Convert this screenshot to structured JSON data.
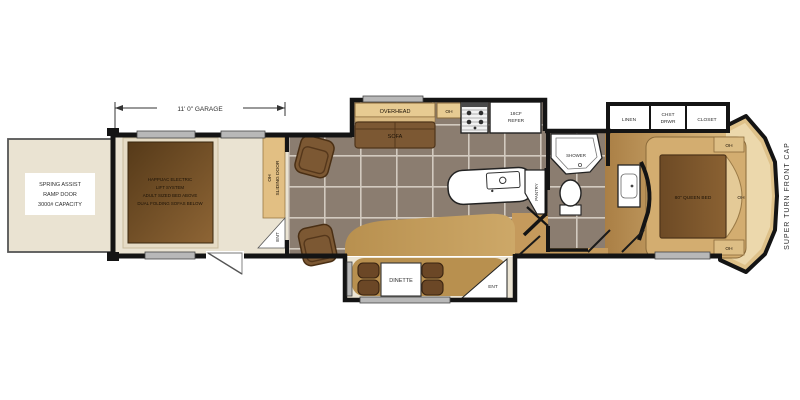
{
  "plan": {
    "dimension_label": "11' 0\" GARAGE",
    "ramp_door": [
      "SPRING ASSIST",
      "RAMP DOOR",
      "3000# CAPACITY"
    ],
    "garage_bed": [
      "HAPPIJAC ELECTRIC",
      "LIFT SYSTEM",
      "ADULT SIZED BED ABOVE",
      "DUAL FOLDING SOFAS BELOW"
    ],
    "garage_wall": {
      "oh": "OH",
      "sliding_door": "SLIDING DOOR",
      "ent": "ENT"
    },
    "living": {
      "overhead": "OVERHEAD",
      "sofa": "SOFA",
      "oh_cabinet": "OH",
      "refer_line1": "18CF",
      "refer_line2": "REFER",
      "pantry": "PANTRY",
      "dinette": "DINETTE",
      "entry": "ENT"
    },
    "bathroom": {
      "shower": "SHOWER"
    },
    "bedroom": {
      "linen": "LINEN",
      "chest_line1": "CHST",
      "chest_line2": "DRWR",
      "closet": "CLOSET",
      "bed": "80\" QUEEN BED",
      "oh_top": "OH",
      "oh_right": "OH",
      "oh_bottom": "OH"
    },
    "front_cap_label": "SUPER TURN FRONT CAP"
  },
  "colors": {
    "wall": "#141414",
    "garage_floor": "#eae3d2",
    "tile": "#8b7d70",
    "grout": "#d2cabf",
    "wood_light": "#d9b87e",
    "wood_dark": "#aa7f45",
    "cabinet_tan": "#e2bf83",
    "furniture_brown": "#7c5833",
    "bed_brown": "#6d4a25",
    "window_gray": "#b8b8b8"
  }
}
